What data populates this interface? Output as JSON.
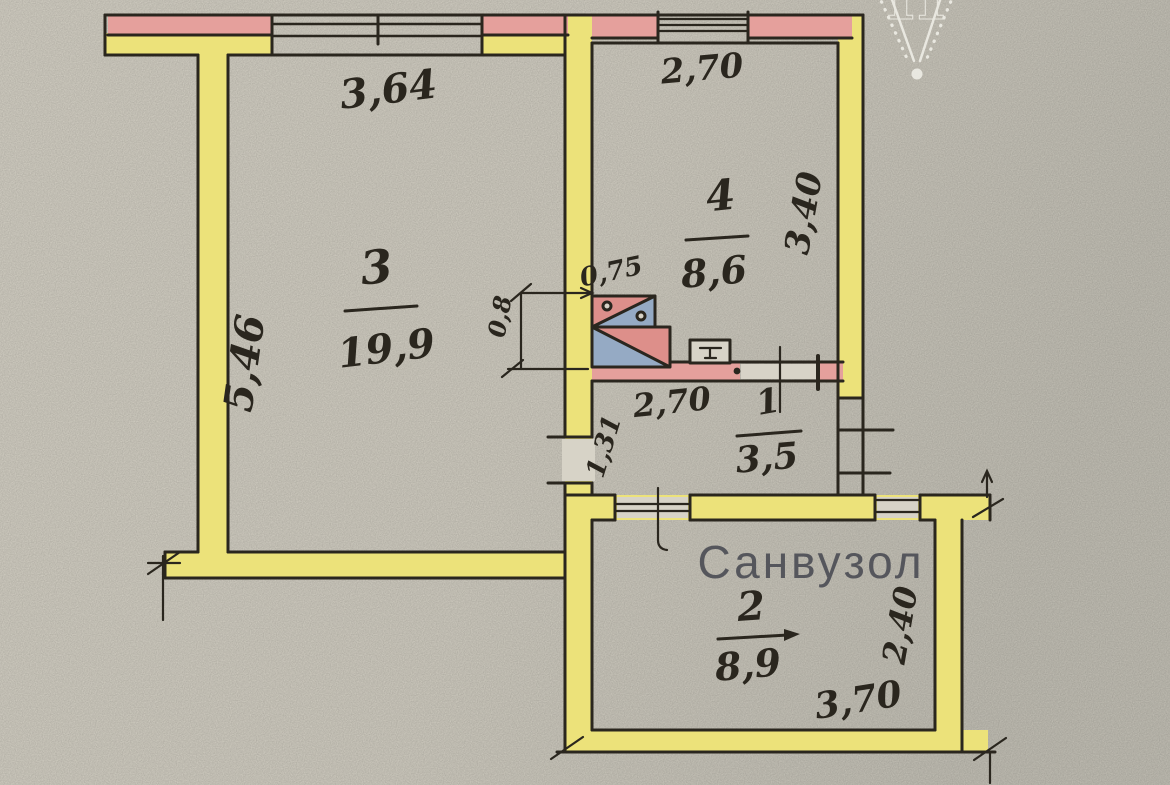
{
  "plan": {
    "bathroom_label": "Санвузол",
    "watermark_letter": "Н",
    "rooms": [
      {
        "number": "3",
        "area": "19,9"
      },
      {
        "number": "4",
        "area": "8,6"
      },
      {
        "number": "1",
        "area": "3,5"
      },
      {
        "number": "2",
        "area": "8,9"
      }
    ],
    "dimensions": {
      "room3_width": "3,64",
      "room3_depth": "5,46",
      "room4_width": "2,70",
      "room4_depth": "3,40",
      "vent_width": "0,75",
      "vent_depth": "0,8",
      "hall_width": "2,70",
      "hall_depth": "1,31",
      "bath_width": "3,70",
      "bath_depth": "2,40"
    },
    "colors": {
      "paper": "#d7d3c7",
      "paper_dark": "#c9c6bb",
      "paper_light": "#dbd7cb",
      "wall_fill": "#ece27a",
      "masonry": "#e5a09c",
      "vent_pink": "#dd8f8a",
      "vent_blue": "#95aac4",
      "ink": "#2a261e",
      "label_gray": "#55565c",
      "watermark": "#f2f1ea"
    }
  }
}
